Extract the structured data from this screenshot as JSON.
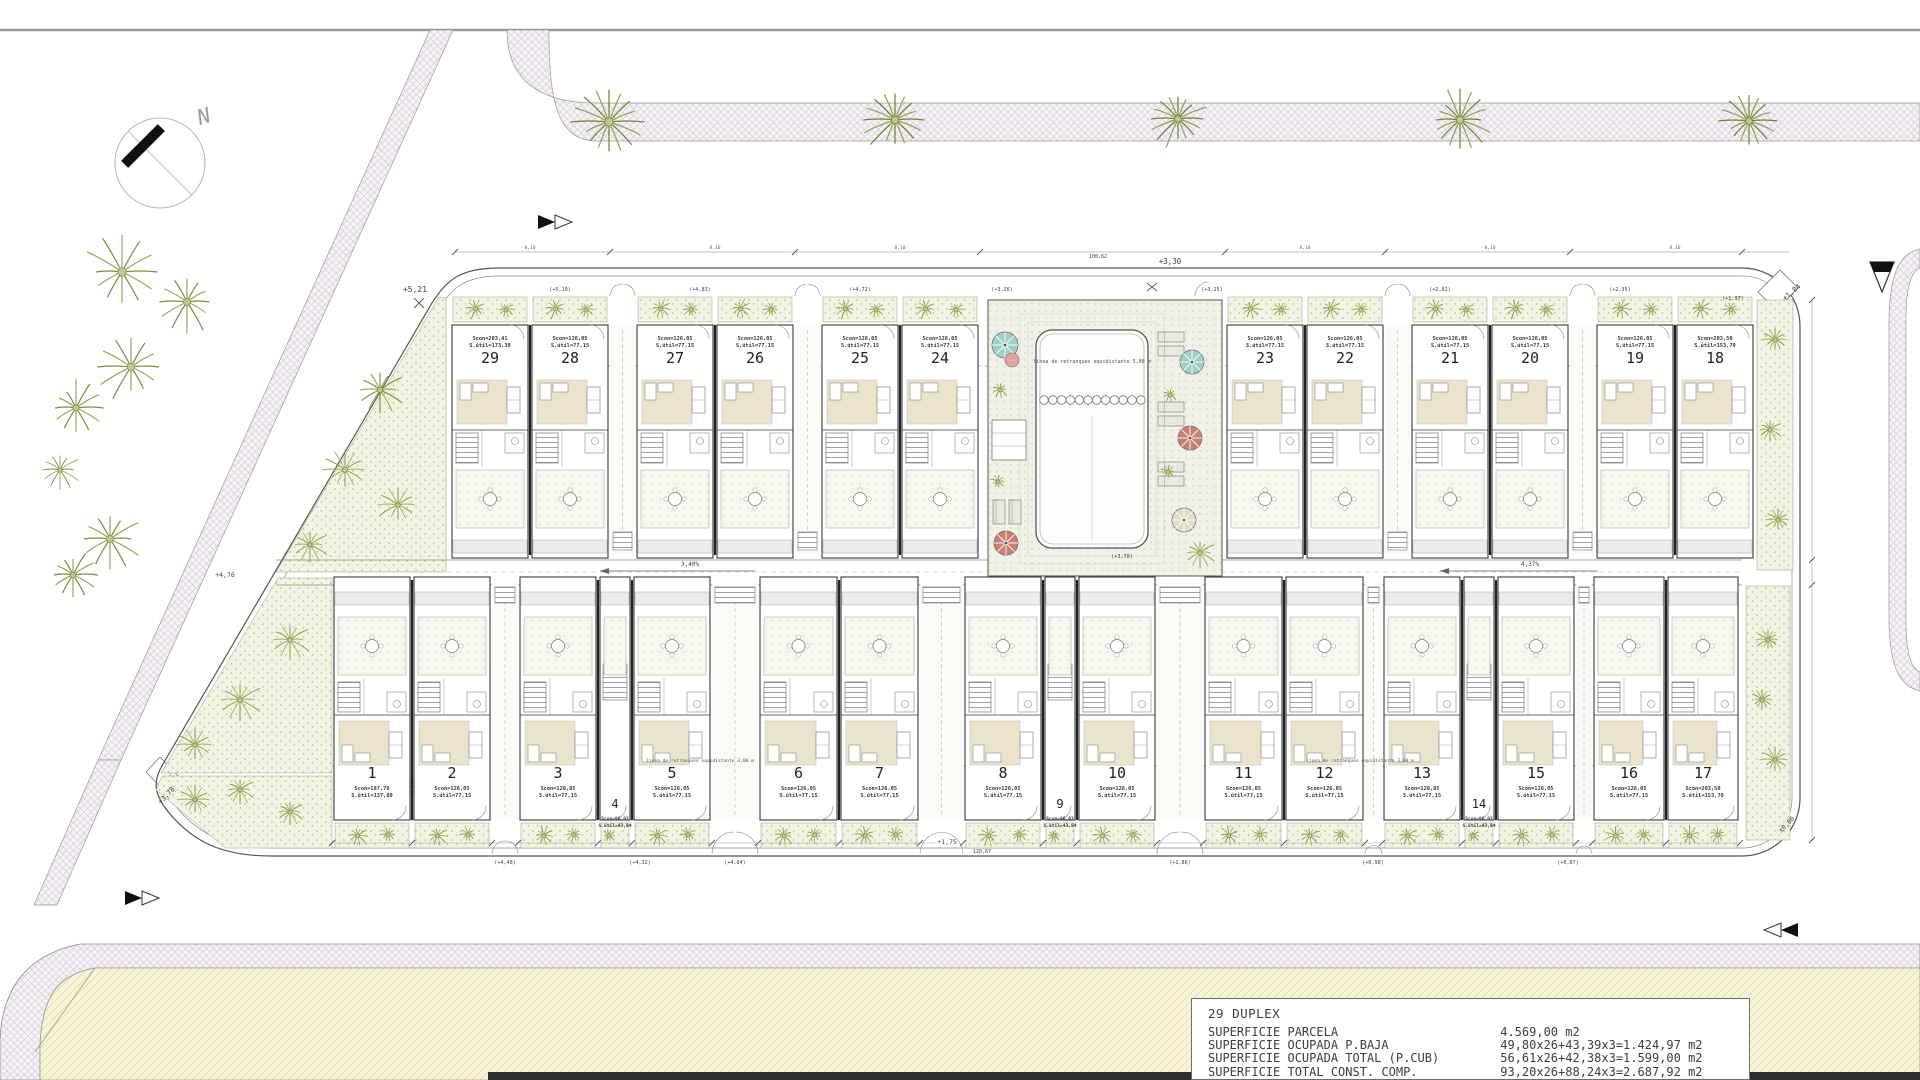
{
  "legend": {
    "title": "29 DUPLEX",
    "rows": [
      {
        "label": "SUPERFICIE PARCELA",
        "value": "4.569,00 m2"
      },
      {
        "label": "SUPERFICIE OCUPADA P.BAJA",
        "value": "49,80x26+43,39x3=1.424,97 m2"
      },
      {
        "label": "SUPERFICIE OCUPADA TOTAL (P.CUB)",
        "value": "56,61x26+42,38x3=1.599,00 m2"
      },
      {
        "label": "SUPERFICIE TOTAL CONST. COMP.",
        "value": "93,20x26+88,24x3=2.687,92 m2"
      }
    ]
  },
  "north_label": "N",
  "pool_setback_note": "línea de retranqueo equidistante 5,00 m",
  "row_setback_note": "línea de retranqueo equidistante 3,00 m",
  "slope_left": "3,40%",
  "slope_right": "4,37%",
  "pair_dim": "8,10",
  "units": {
    "top_left": [
      {
        "num": "29",
        "scon": "Scon=203,41",
        "sutil": "S.útil=173,39"
      },
      {
        "num": "28",
        "scon": "Scon=126,05",
        "sutil": "S.útil=77,15"
      },
      {
        "num": "27",
        "scon": "Scon=126,05",
        "sutil": "S.útil=77,15"
      },
      {
        "num": "26",
        "scon": "Scon=126,05",
        "sutil": "S.útil=77,15"
      },
      {
        "num": "25",
        "scon": "Scon=126,05",
        "sutil": "S.útil=77,15"
      },
      {
        "num": "24",
        "scon": "Scon=126,05",
        "sutil": "S.útil=77,15"
      }
    ],
    "top_right": [
      {
        "num": "23",
        "scon": "Scon=126,05",
        "sutil": "S.útil=77,15"
      },
      {
        "num": "22",
        "scon": "Scon=126,05",
        "sutil": "S.útil=77,15"
      },
      {
        "num": "21",
        "scon": "Scon=126,05",
        "sutil": "S.útil=77,15"
      },
      {
        "num": "20",
        "scon": "Scon=126,05",
        "sutil": "S.útil=77,15"
      },
      {
        "num": "19",
        "scon": "Scon=126,05",
        "sutil": "S.útil=77,15"
      },
      {
        "num": "18",
        "scon": "Scon=203,50",
        "sutil": "S.útil=153,70"
      }
    ],
    "bottom": [
      {
        "num": "1",
        "scon": "Scon=187,76",
        "sutil": "S.útil=137,80"
      },
      {
        "num": "2",
        "scon": "Scon=126,05",
        "sutil": "S.útil=77,15"
      },
      {
        "num": "3",
        "scon": "Scon=126,05",
        "sutil": "S.útil=77,15"
      },
      {
        "num": "4",
        "narrow": true,
        "scon": "Scon=86,03",
        "sutil": "S.útil=43,84"
      },
      {
        "num": "5",
        "scon": "Scon=126,05",
        "sutil": "S.útil=77,15"
      },
      {
        "num": "6",
        "scon": "Scon=126,05",
        "sutil": "S.útil=77,15"
      },
      {
        "num": "7",
        "scon": "Scon=126,05",
        "sutil": "S.útil=77,15"
      },
      {
        "num": "8",
        "scon": "Scon=126,05",
        "sutil": "S.útil=77,15"
      },
      {
        "num": "9",
        "narrow": true,
        "scon": "Scon=86,03",
        "sutil": "S.útil=43,84"
      },
      {
        "num": "10",
        "scon": "Scon=126,05",
        "sutil": "S.útil=77,15"
      },
      {
        "num": "11",
        "scon": "Scon=126,05",
        "sutil": "S.útil=77,15"
      },
      {
        "num": "12",
        "scon": "Scon=126,05",
        "sutil": "S.útil=77,15"
      },
      {
        "num": "13",
        "scon": "Scon=126,05",
        "sutil": "S.útil=77,15"
      },
      {
        "num": "14",
        "narrow": true,
        "scon": "Scon=86,03",
        "sutil": "S.útil=43,84"
      },
      {
        "num": "15",
        "scon": "Scon=126,05",
        "sutil": "S.útil=77,15"
      },
      {
        "num": "16",
        "scon": "Scon=126,05",
        "sutil": "S.útil=77,15"
      },
      {
        "num": "17",
        "scon": "Scon=203,50",
        "sutil": "S.útil=153,70"
      }
    ]
  },
  "gate_levels_top": [
    {
      "text": "(+5,10)",
      "x": 560
    },
    {
      "text": "(+4,83)",
      "x": 700
    },
    {
      "text": "(+4,72)",
      "x": 860
    },
    {
      "text": "(+3,26)",
      "x": 1002
    },
    {
      "text": "(+3,15)",
      "x": 1212
    },
    {
      "text": "(+2,82)",
      "x": 1440
    },
    {
      "text": "(+2,35)",
      "x": 1620
    }
  ],
  "gate_levels_bottom": [
    {
      "text": "(+4,48)",
      "x": 505
    },
    {
      "text": "(+4,32)",
      "x": 640
    },
    {
      "text": "(+4,04)",
      "x": 735
    },
    {
      "text": "(+1,86)",
      "x": 1180
    },
    {
      "text": "(+0,98)",
      "x": 1373
    },
    {
      "text": "(+0,87)",
      "x": 1568
    }
  ],
  "annotations": [
    {
      "text": "+5,21",
      "x": 415,
      "y": 292,
      "size": 8,
      "rot": 0
    },
    {
      "text": "+3,30",
      "x": 1170,
      "y": 264,
      "size": 7.5,
      "rot": 0
    },
    {
      "text": "100,62",
      "x": 1098,
      "y": 258,
      "size": 5,
      "rot": 0
    },
    {
      "text": "+1,84",
      "x": 1793,
      "y": 294,
      "size": 7,
      "rot": -40
    },
    {
      "text": "(+1,97)",
      "x": 1733,
      "y": 300,
      "size": 5.2,
      "rot": 0
    },
    {
      "text": "+4,76",
      "x": 225,
      "y": 577,
      "size": 6.5,
      "rot": 0
    },
    {
      "text": "+3,78",
      "x": 168,
      "y": 797,
      "size": 7,
      "rot": -47
    },
    {
      "text": "±0,00",
      "x": 1788,
      "y": 826,
      "size": 6.5,
      "rot": -45
    },
    {
      "text": "+1,75",
      "x": 947,
      "y": 844,
      "size": 6.5,
      "rot": 0
    },
    {
      "text": "120,67",
      "x": 982,
      "y": 853,
      "size": 5,
      "rot": 0
    },
    {
      "text": "(+3,70)",
      "x": 1122,
      "y": 558,
      "size": 5.2,
      "rot": 0
    }
  ]
}
